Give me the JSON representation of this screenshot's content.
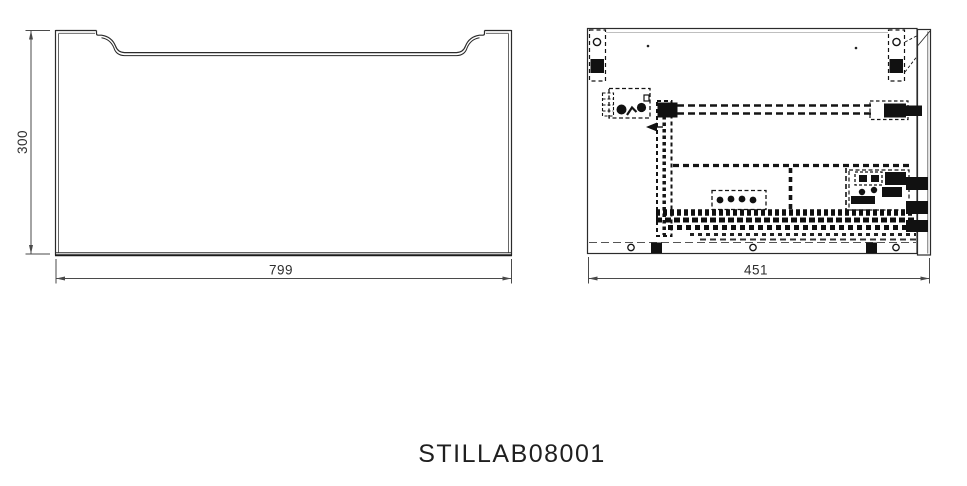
{
  "title": "STILLAB08001",
  "views": {
    "front": {
      "width_label": "799",
      "height_label": "300"
    },
    "side": {
      "depth_label": "451"
    }
  },
  "colors": {
    "outline": "#2b2b2b",
    "hidden_hardware": "#141414",
    "dimension_line": "#4a4a4a",
    "background": "#ffffff",
    "text": "#1f1f1f"
  }
}
